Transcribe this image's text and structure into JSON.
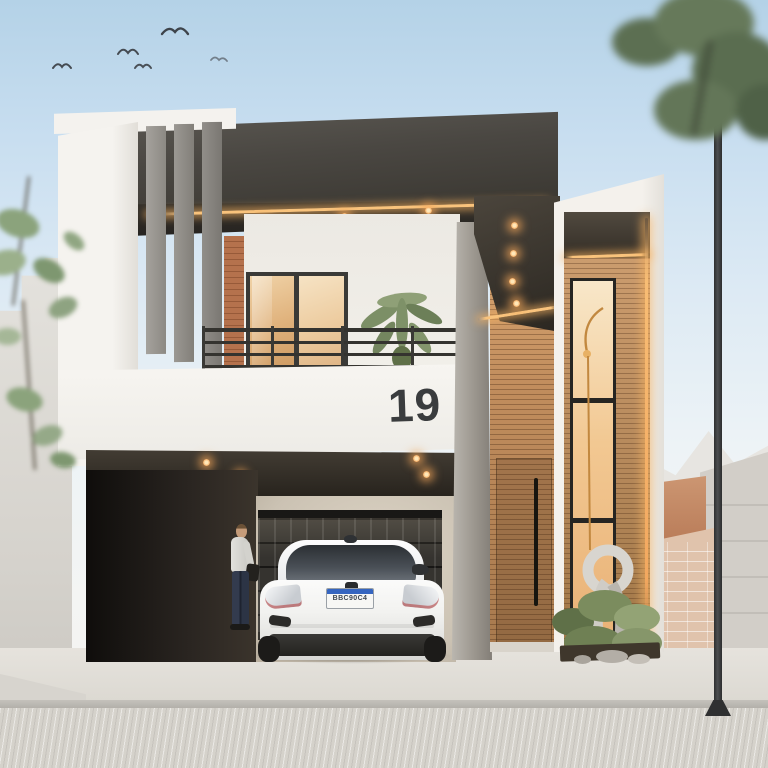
{
  "scene": {
    "type": "exterior-architectural-render",
    "description": "Modern two-story minimalist house with dark cantilevered fascia, wood slat cladding, balcony, carport with white hatchback, warm LED soffit lighting, pale blue sky with birds"
  },
  "house": {
    "number": "19",
    "number_color": "#3a3c3e"
  },
  "car": {
    "type": "white hatchback, rear view",
    "license_plate": "BBC90C4",
    "plate_accent": "#3565c0"
  },
  "figures": {
    "person": "man in white t-shirt and dark jeans standing in carport"
  },
  "lighting": {
    "led_accent": "#f6b368",
    "downlights": "warm recessed spots under fascia and carport ceiling"
  },
  "palette": {
    "sky_top": "#b4d2e7",
    "sky_horizon": "#f3f4f2",
    "fascia_dark": "#47433d",
    "wall_white": "#f3f0eb",
    "wood": "#bb8a5e",
    "brick": "#ad6c48",
    "concrete_pillar": "#9b968f",
    "neighbor_wall": "#d9d6d1",
    "terracotta": "#c08366",
    "road": "#d5d2cb",
    "car_white": "#f2f2f0",
    "foliage": "#7c8f66",
    "garage_dark": "#1d1a16"
  }
}
